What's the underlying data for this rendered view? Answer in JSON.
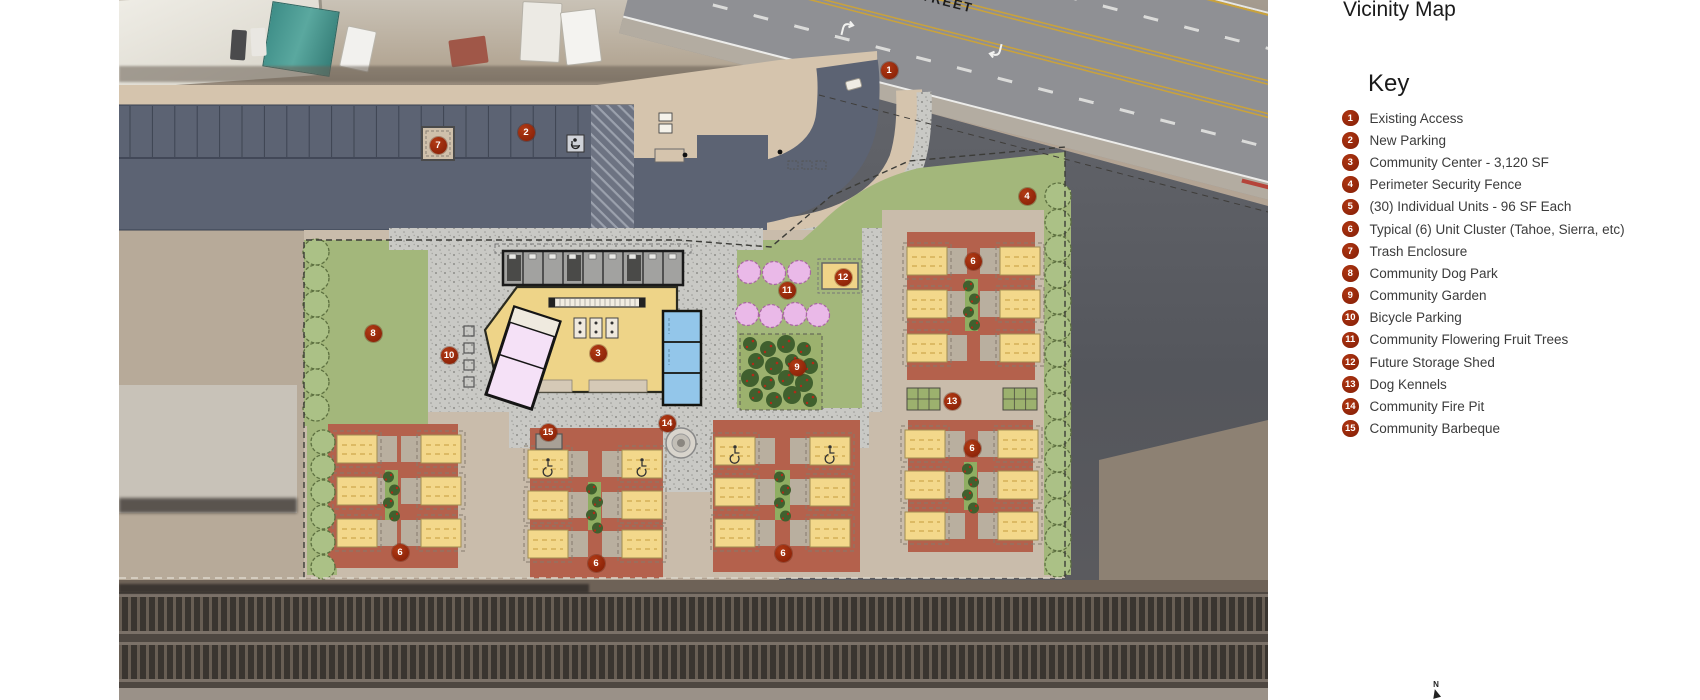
{
  "panel": {
    "title": "Vicinity Map",
    "key_heading": "Key",
    "items": [
      {
        "n": "1",
        "label": "Existing Access"
      },
      {
        "n": "2",
        "label": "New Parking"
      },
      {
        "n": "3",
        "label": "Community Center - 3,120 SF"
      },
      {
        "n": "4",
        "label": "Perimeter Security Fence"
      },
      {
        "n": "5",
        "label": "(30) Individual Units - 96 SF Each"
      },
      {
        "n": "6",
        "label": "Typical (6) Unit Cluster (Tahoe, Sierra, etc)"
      },
      {
        "n": "7",
        "label": "Trash Enclosure"
      },
      {
        "n": "8",
        "label": "Community Dog Park"
      },
      {
        "n": "9",
        "label": "Community Garden"
      },
      {
        "n": "10",
        "label": "Bicycle Parking"
      },
      {
        "n": "11",
        "label": "Community Flowering Fruit Trees"
      },
      {
        "n": "12",
        "label": "Future Storage Shed"
      },
      {
        "n": "13",
        "label": "Dog Kennels"
      },
      {
        "n": "14",
        "label": "Community Fire Pit"
      },
      {
        "n": "15",
        "label": "Community Barbeque"
      }
    ]
  },
  "map": {
    "street_label": "STREET",
    "north_label": "N",
    "markers": [
      {
        "n": "1",
        "x": 770,
        "y": 70
      },
      {
        "n": "2",
        "x": 407,
        "y": 132
      },
      {
        "n": "3",
        "x": 479,
        "y": 353
      },
      {
        "n": "4",
        "x": 908,
        "y": 196
      },
      {
        "n": "6",
        "x": 854,
        "y": 261
      },
      {
        "n": "6",
        "x": 853,
        "y": 448
      },
      {
        "n": "6",
        "x": 281,
        "y": 552
      },
      {
        "n": "6",
        "x": 477,
        "y": 563
      },
      {
        "n": "6",
        "x": 664,
        "y": 553
      },
      {
        "n": "7",
        "x": 319,
        "y": 145
      },
      {
        "n": "8",
        "x": 254,
        "y": 333
      },
      {
        "n": "9",
        "x": 678,
        "y": 367
      },
      {
        "n": "10",
        "x": 330,
        "y": 355
      },
      {
        "n": "11",
        "x": 668,
        "y": 290
      },
      {
        "n": "12",
        "x": 724,
        "y": 277
      },
      {
        "n": "13",
        "x": 833,
        "y": 401
      },
      {
        "n": "14",
        "x": 548,
        "y": 423
      },
      {
        "n": "15",
        "x": 429,
        "y": 432
      }
    ],
    "colors": {
      "marker": "#9c2d0e",
      "cluster_pad": "#b4614c",
      "unit_yellow": "#f3d88b",
      "lawn_green": "#a3b77b",
      "tree_green": "#abc186",
      "parking_gray": "#5c6373",
      "sidewalk_tan": "#d5c4ad",
      "site_pad": "#c9bcab",
      "gravel": "#c9c9c5",
      "center_yellow": "#eed488",
      "annex_pink": "#f5e1f7",
      "rooms_blue": "#93c6ea",
      "garden_green": "#40602e",
      "flower_pink": "#eab9e8",
      "rail_dark": "#4e4741"
    }
  }
}
